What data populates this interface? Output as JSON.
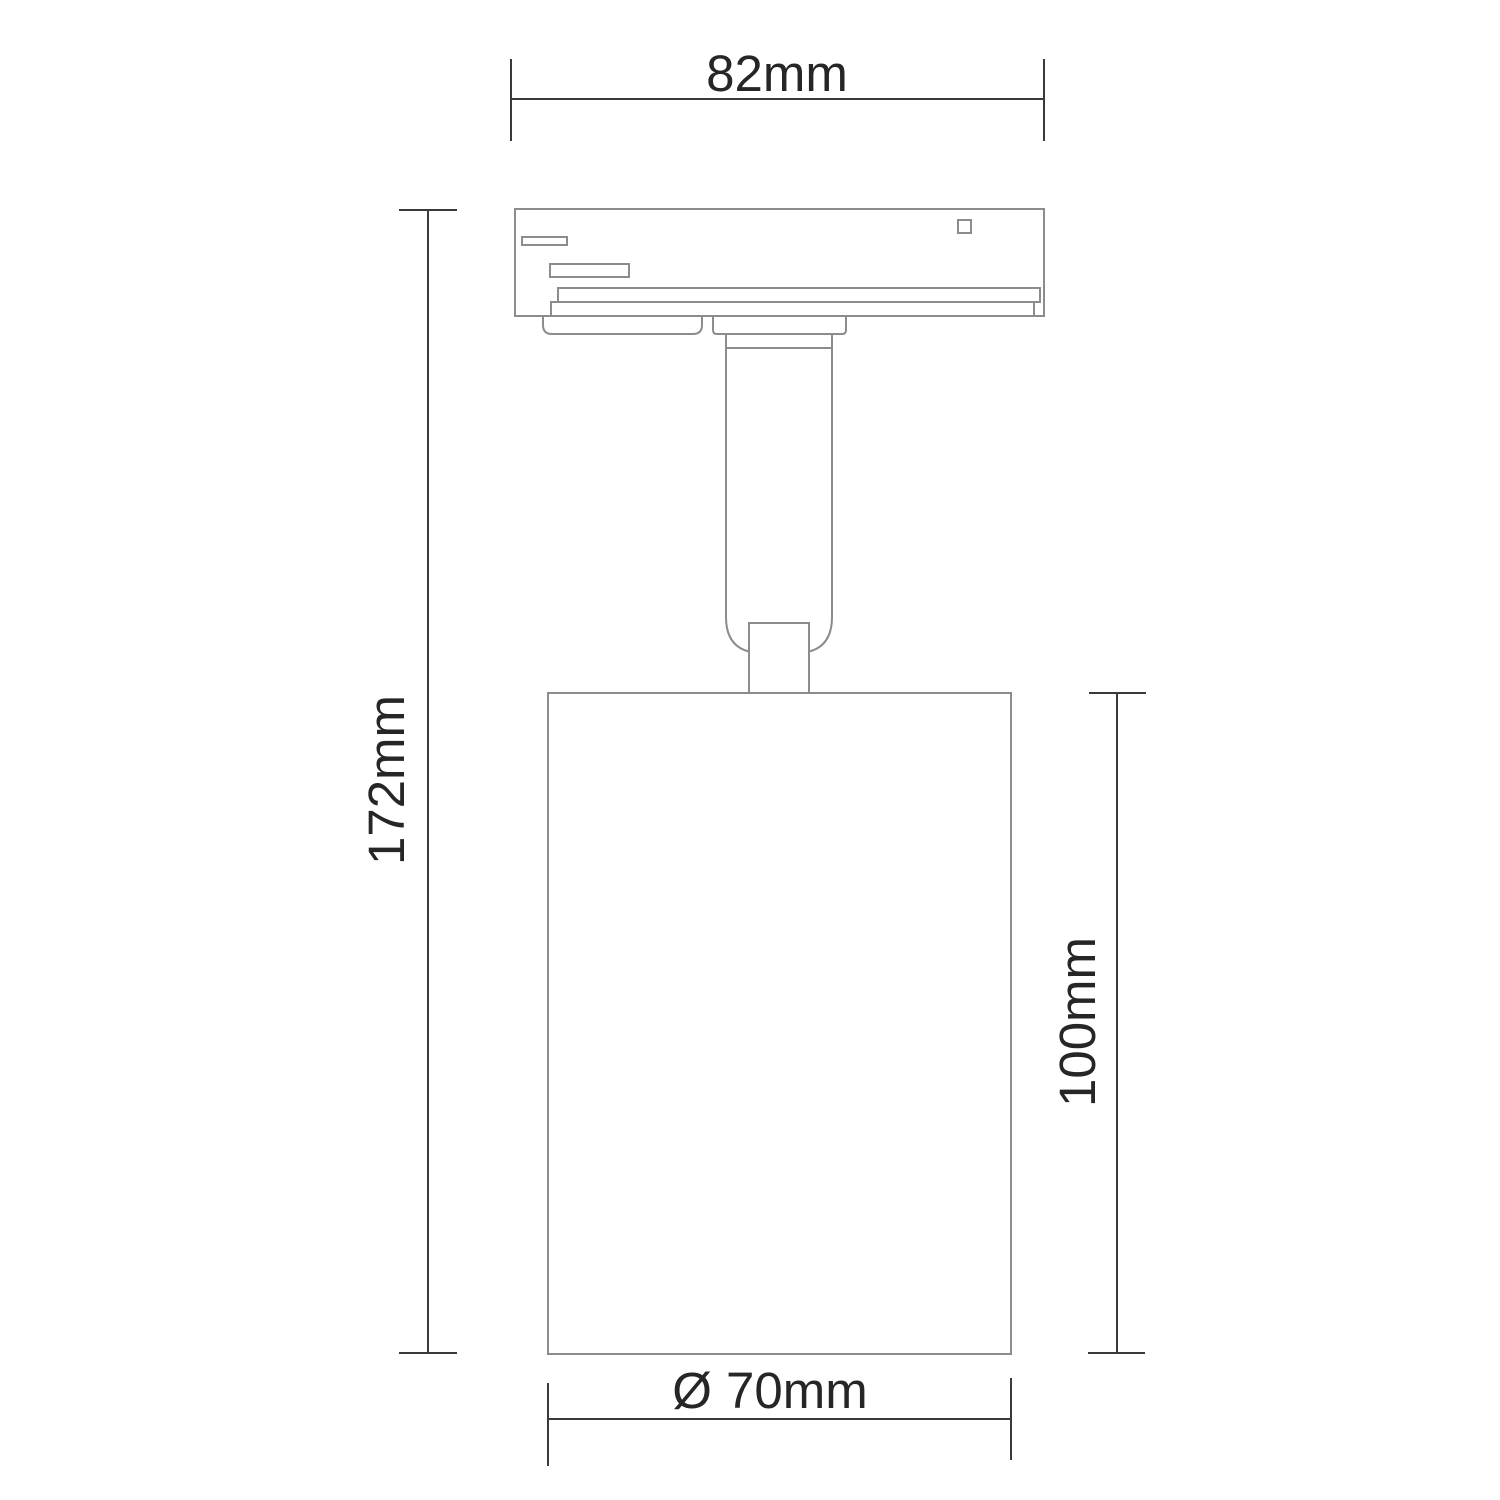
{
  "page": {
    "background": "#ffffff",
    "description": "Technical dimension drawing of a cylindrical track-light spotlight fixture"
  },
  "drawing": {
    "outline_color": "#8c8c8c",
    "dimension_color": "#3a3a3a",
    "text_color": "#262626",
    "labels": {
      "adapter_width": "82mm",
      "overall_height": "172mm",
      "body_height": "100mm",
      "body_diameter": "Ø 70mm"
    }
  }
}
